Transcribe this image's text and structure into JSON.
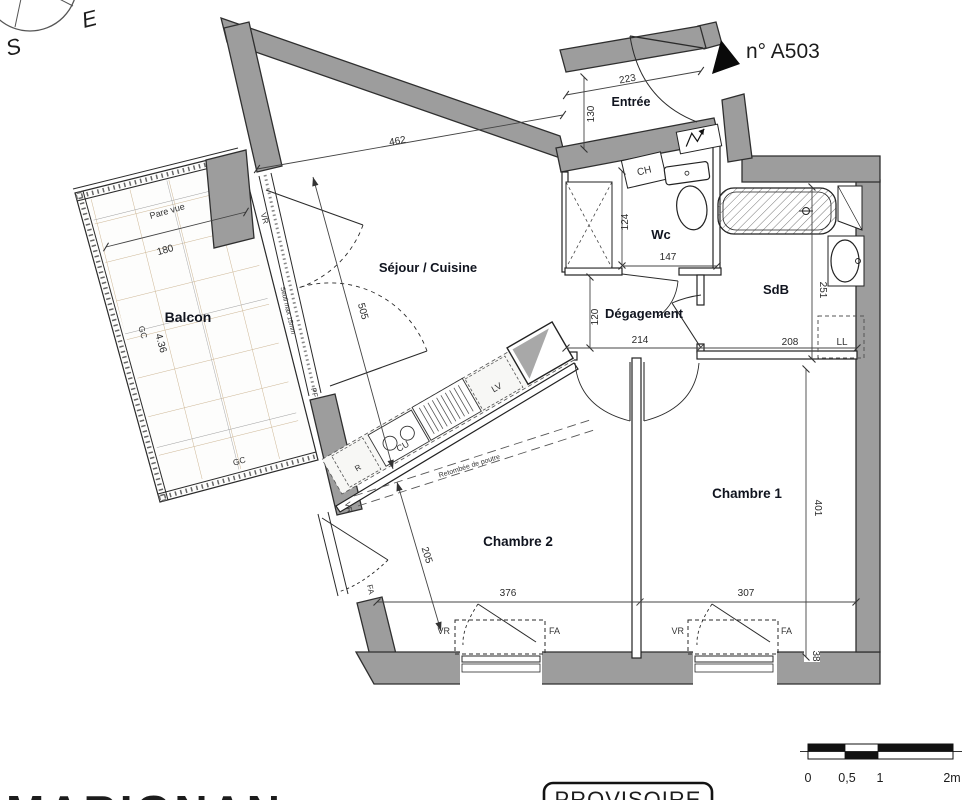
{
  "plan": {
    "unit": "n° A503",
    "compass": {
      "e": "E",
      "s": "S"
    },
    "rooms": {
      "entree": "Entrée",
      "sejour": "Séjour / Cuisine",
      "balcon": "Balcon",
      "wc": "Wc",
      "sdb": "SdB",
      "degagement": "Dégagement",
      "chambre1": "Chambre 1",
      "chambre2": "Chambre 2"
    },
    "dims": {
      "entree_w": "223",
      "entree_d": "130",
      "sejour_w": "462",
      "sejour_h": "505",
      "balcon_w": "180",
      "balcon_l": "4.36",
      "wc_h": "124",
      "wc_w": "147",
      "deg_h": "120",
      "deg_w": "214",
      "sdb_w": "208",
      "sdb_h": "251",
      "ch1_h": "401",
      "ch1_w": "307",
      "ch2_w": "376",
      "ch2_h": "205",
      "wall": "38"
    },
    "ann": {
      "pare_vue": "Pare vue",
      "gc": "GC",
      "vr": "VR",
      "fa": "FA",
      "pf": "PF",
      "seuil": "Seuil max 15mm",
      "fridge": "R",
      "hob": "CU",
      "dishwasher": "LV",
      "beam": "Retombée de poutre",
      "boiler": "CH",
      "washer": "LL"
    },
    "scale_bar": {
      "labels": [
        "0",
        "0,5",
        "1",
        "2m"
      ]
    },
    "stamp": "PROVISOIRE",
    "logo": "MARIGNAN",
    "colors": {
      "wall": "#9d9d9d",
      "outline": "#2f2f2f",
      "tile": "#cdb694",
      "logo": "#25395c"
    }
  }
}
